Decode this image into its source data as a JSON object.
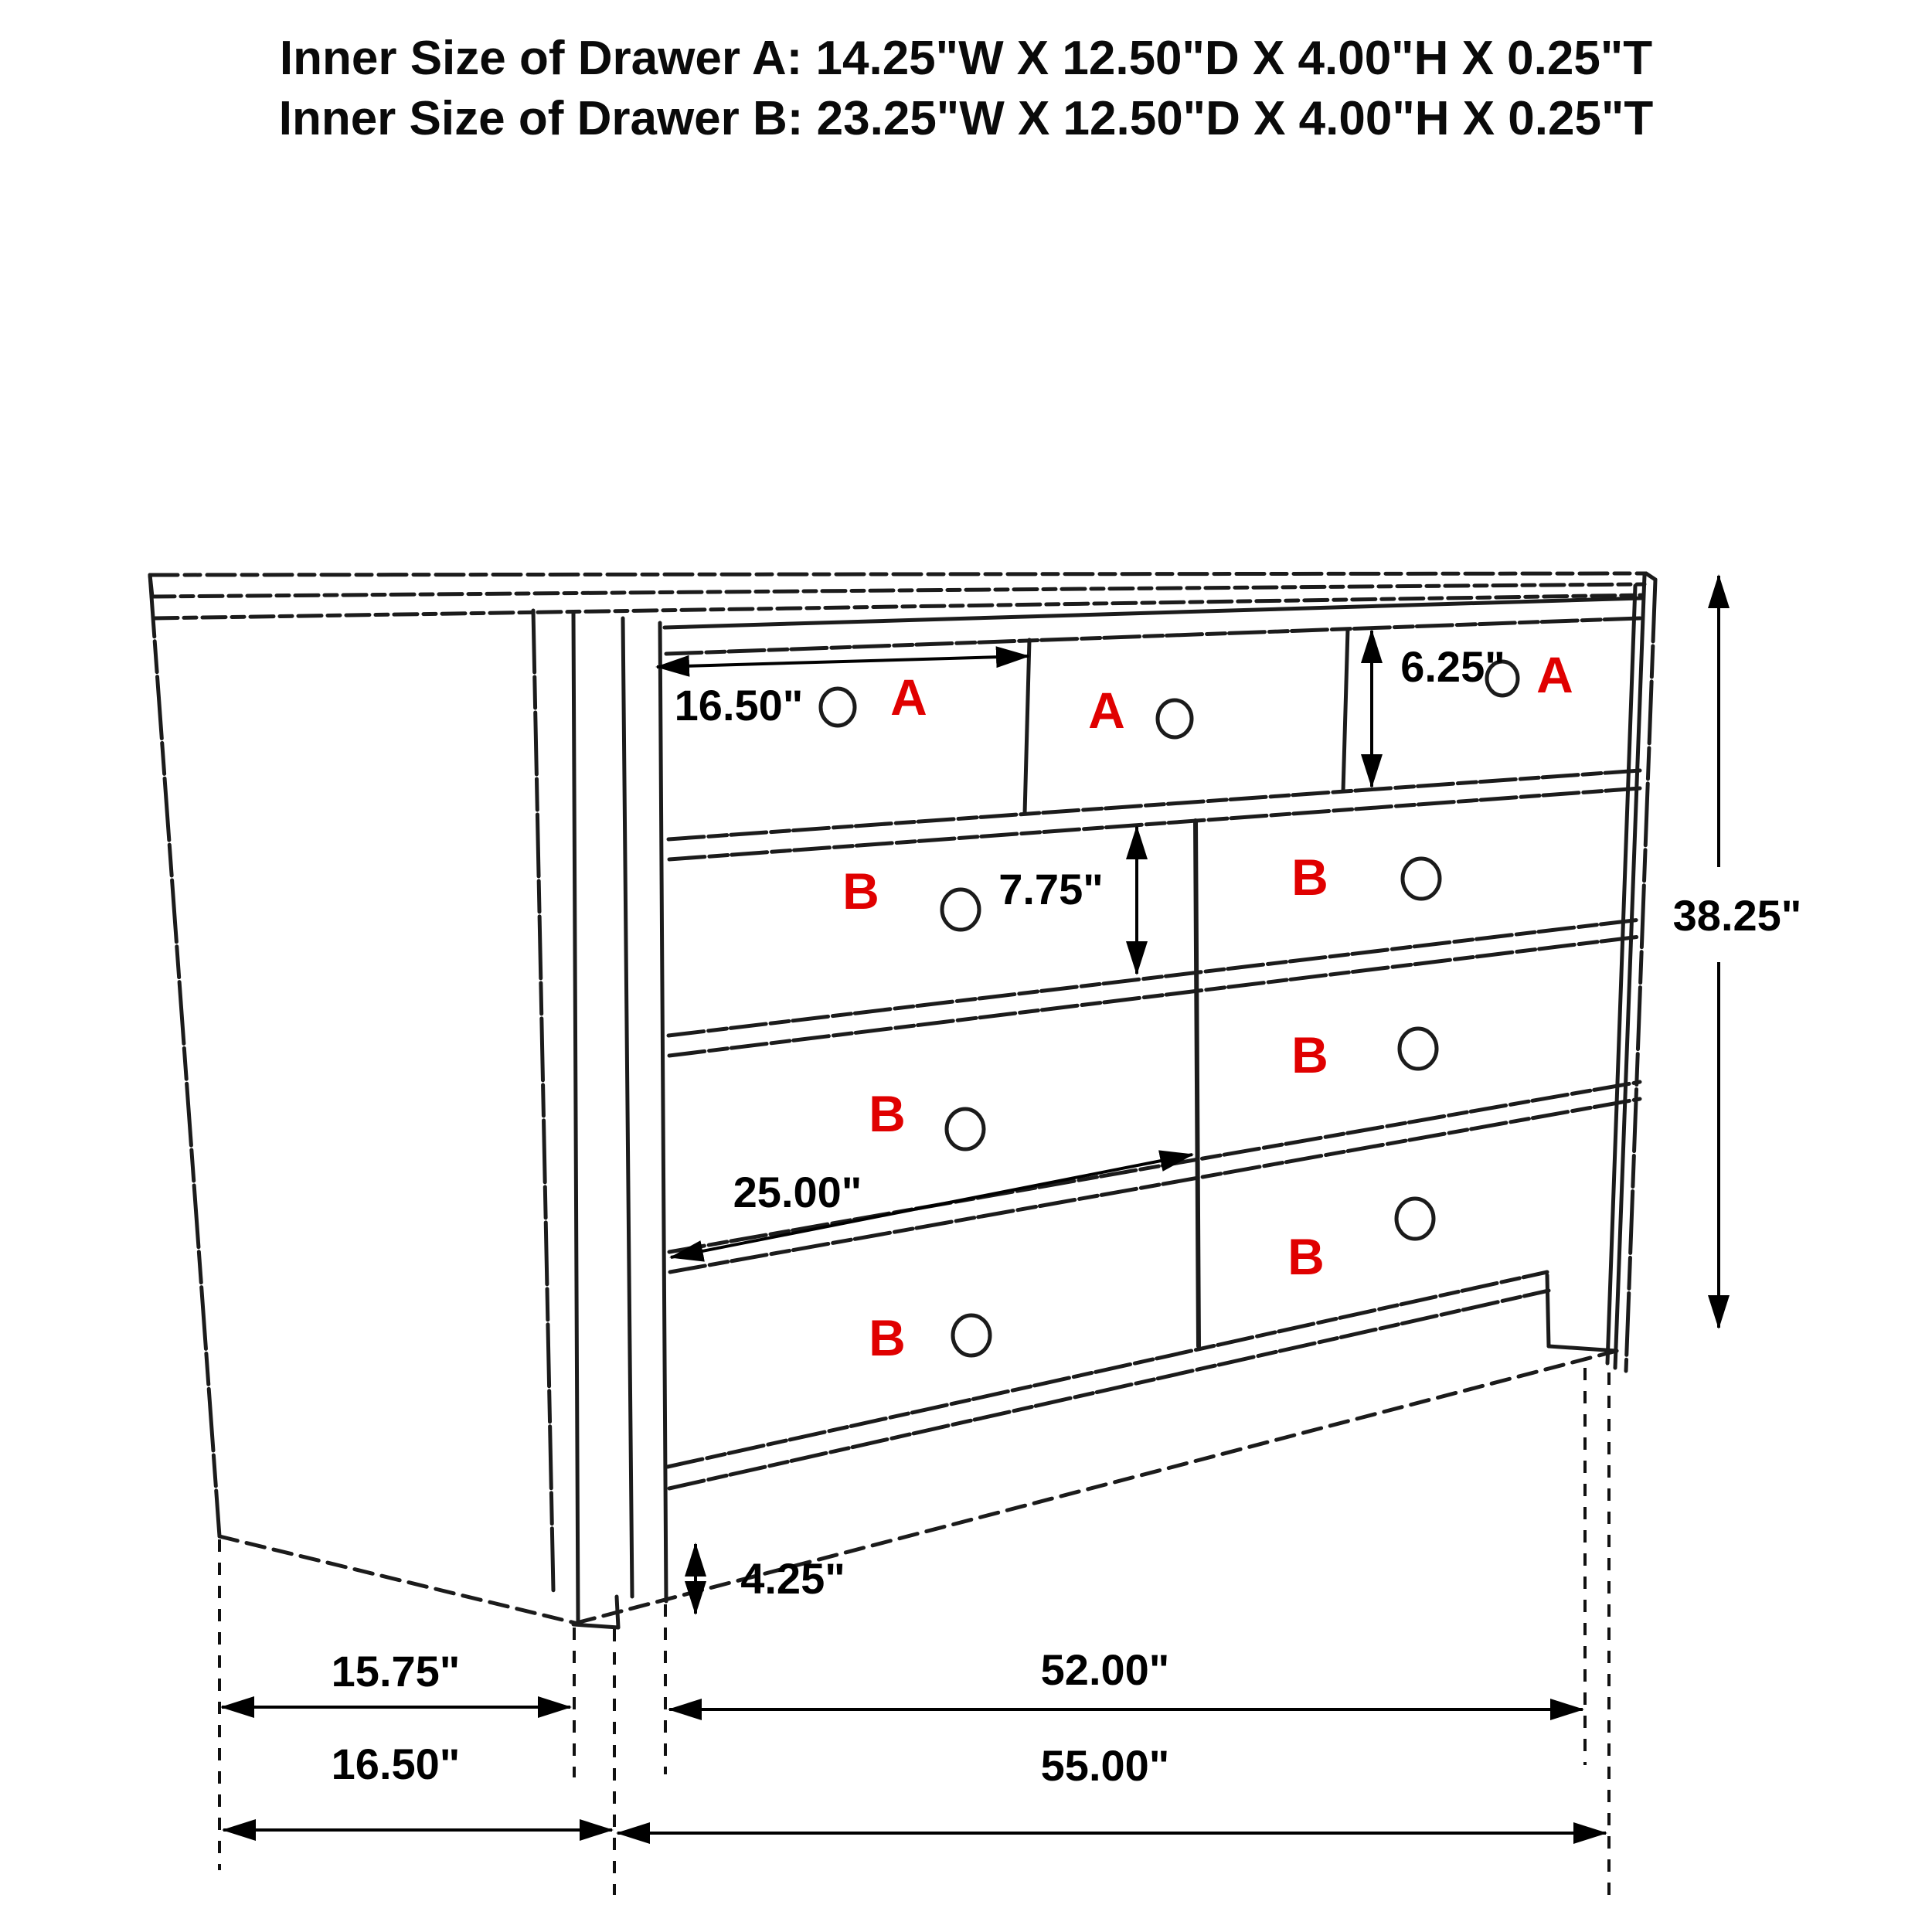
{
  "title": {
    "line1": "Inner Size of Drawer A: 14.25\"W X 12.50\"D X 4.00\"H X 0.25\"T",
    "line2": "Inner Size of Drawer B: 23.25\"W X 12.50\"D X 4.00\"H X 0.25\"T"
  },
  "drawer_labels": {
    "a": "A",
    "b": "B"
  },
  "dimensions": {
    "drawer_a_width": "16.50\"",
    "drawer_a_face_height": "6.25\"",
    "drawer_b_face_height": "7.75\"",
    "overall_height": "38.25\"",
    "drawer_b_width": "25.00\"",
    "base_height": "4.25\"",
    "side_depth_top": "15.75\"",
    "front_width_top": "52.00\"",
    "side_depth_overall": "16.50\"",
    "front_width_overall": "55.00\""
  },
  "colors": {
    "drawer_letter": "#e00000",
    "line": "#1b1b1b",
    "dimension_text": "#000000"
  }
}
